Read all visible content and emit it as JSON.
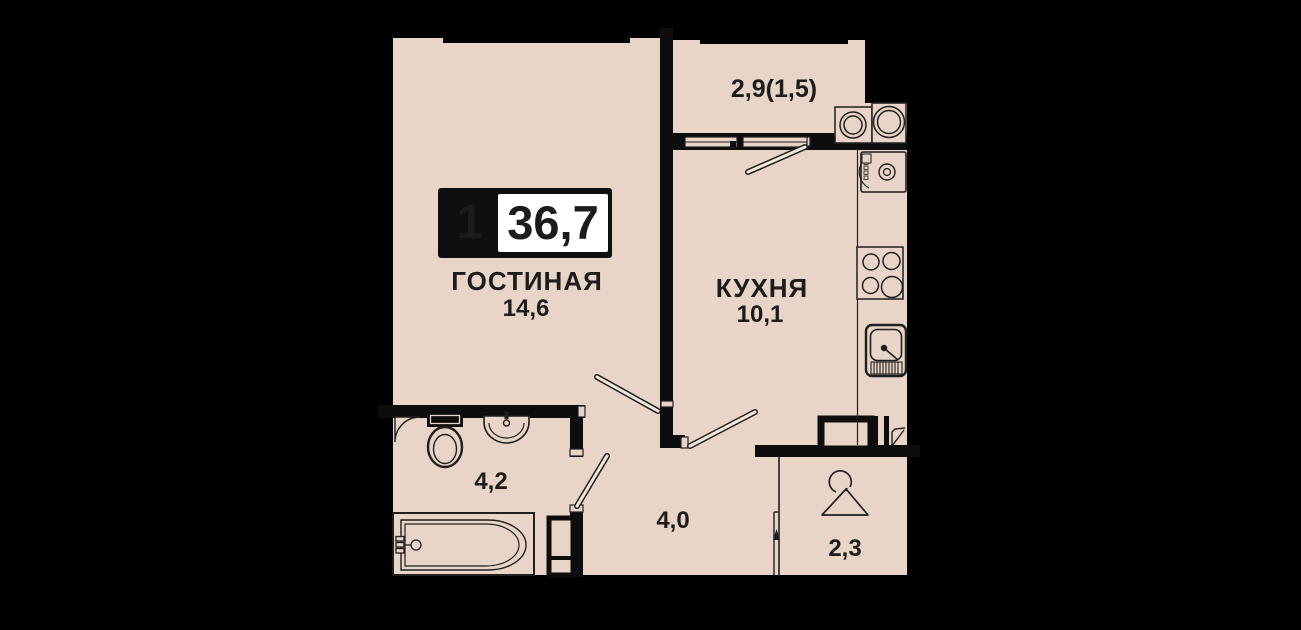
{
  "badge": {
    "room_count": "1",
    "total_area": "36,7"
  },
  "rooms": {
    "living": {
      "name": "ГОСТИНАЯ",
      "area": "14,6"
    },
    "kitchen": {
      "name": "КУХНЯ",
      "area": "10,1"
    },
    "balcony": {
      "area": "2,9(1,5)"
    },
    "bathroom": {
      "area": "4,2"
    },
    "hallway": {
      "area": "4,0"
    },
    "wardrobe": {
      "area": "2,3"
    }
  },
  "colors": {
    "background": "#000000",
    "floor": "#e8d5c7",
    "wall": "#0d0d0d",
    "fixture_stroke": "#1f1f1f",
    "badge_bg": "#0f0f0f",
    "badge_fg": "#ffffff",
    "label": "#1c1c1c"
  },
  "icons": [
    "toilet-icon",
    "washbasin-icon",
    "bathtub-icon",
    "corner-shelf-icon",
    "stove-icon",
    "kitchen-sink-icon",
    "fridge-icon",
    "balcony-unit-icon",
    "hanger-icon",
    "door-leaf",
    "window",
    "vent-shaft",
    "entrance-door"
  ]
}
